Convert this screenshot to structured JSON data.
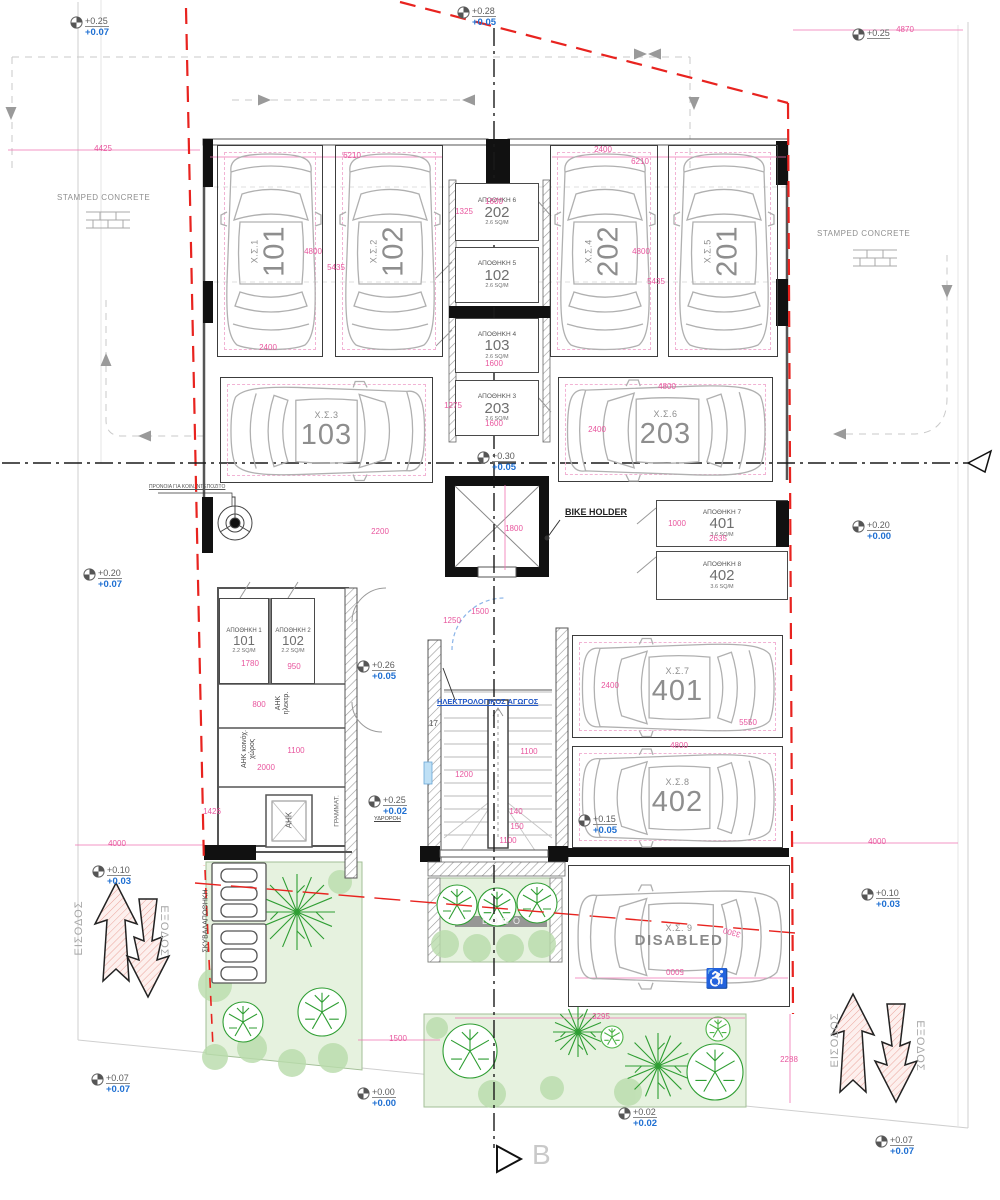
{
  "labels": {
    "stamped_concrete_left": "STAMPED CONCRETE",
    "stamped_concrete_right": "STAMPED CONCRETE",
    "bike_holder": "BIKE HOLDER",
    "provision_note": "ΠΡΟΝΟΙΑ ΓΙΑ ΚΟΙΝ. ΝΤΕΠΟΖΙΤΟ",
    "electrical_duct": "ΗΛΕΚΤΡΟΛΟΓΙΚΟΣ ΑΓΩΓΟΣ",
    "mailboxes": "ΓΡΑΜΜΑΤ.",
    "downpipe": "ΥΔΡΟΡΟΗ",
    "ahk_room": "ΑΗΚ",
    "ahk_electrical_1": "ΑΗΚ",
    "ahk_electrical_2": "ηλεκτρ.",
    "ahk_common_1": "ΑΗΚ κοινόχ.",
    "ahk_common_2": "χώρος",
    "garbage_storage": "ΣΚΥΒΑΛΑΠΟΘΗΚΗ",
    "entrance_left": "ΕΙΣΟΔΟΣ",
    "exit_left": "ΕΞΟΔΟΣ",
    "entrance_right": "ΕΙΣΟΔΟΣ",
    "exit_right": "ΕΞΟΔΟΣ",
    "logo": "LOGO",
    "stair_count": "17",
    "section_b": "B",
    "wheelchair": "♿"
  },
  "parking_stalls": [
    {
      "code": "Χ.Σ.1",
      "number": "101"
    },
    {
      "code": "Χ.Σ.2",
      "number": "102"
    },
    {
      "code": "Χ.Σ.4",
      "number": "202"
    },
    {
      "code": "Χ.Σ.5",
      "number": "201"
    },
    {
      "code": "Χ.Σ.3",
      "number": "103"
    },
    {
      "code": "Χ.Σ.6",
      "number": "203"
    },
    {
      "code": "Χ.Σ.7",
      "number": "401"
    },
    {
      "code": "Χ.Σ.8",
      "number": "402"
    },
    {
      "code": "Χ.Σ. 9",
      "number": "DISABLED"
    }
  ],
  "storage_rooms": [
    {
      "name": "ΑΠΟΘΗΚΗ 6",
      "number": "202",
      "area": "2.6 SQ/M"
    },
    {
      "name": "ΑΠΟΘΗΚΗ 5",
      "number": "102",
      "area": "2.6 SQ/M"
    },
    {
      "name": "ΑΠΟΘΗΚΗ 4",
      "number": "103",
      "area": "2.6 SQ/M"
    },
    {
      "name": "ΑΠΟΘΗΚΗ 3",
      "number": "203",
      "area": "2.6 SQ/M"
    },
    {
      "name": "ΑΠΟΘΗΚΗ 1",
      "number": "101",
      "area": "2.2 SQ/M"
    },
    {
      "name": "ΑΠΟΘΗΚΗ 2",
      "number": "102",
      "area": "2.2 SQ/M"
    },
    {
      "name": "ΑΠΟΘΗΚΗ 7",
      "number": "401",
      "area": "3.6 SQ/M"
    },
    {
      "name": "ΑΠΟΘΗΚΗ 8",
      "number": "402",
      "area": "3.6 SQ/M"
    }
  ],
  "level_markers": [
    {
      "upper": "+0.25",
      "lower": "+0.07"
    },
    {
      "upper": "+0.28",
      "lower": "+0.05"
    },
    {
      "upper": "+0.25",
      "lower": ""
    },
    {
      "upper": "+0.30",
      "lower": "+0.05"
    },
    {
      "upper": "+0.20",
      "lower": "+0.00"
    },
    {
      "upper": "+0.20",
      "lower": "+0.07"
    },
    {
      "upper": "+0.26",
      "lower": "+0.05"
    },
    {
      "upper": "+0.25",
      "lower": "+0.02"
    },
    {
      "upper": "+0.15",
      "lower": "+0.05"
    },
    {
      "upper": "+0.10",
      "lower": "+0.03"
    },
    {
      "upper": "+0.10",
      "lower": "+0.03"
    },
    {
      "upper": "+0.07",
      "lower": "+0.07"
    },
    {
      "upper": "+0.00",
      "lower": "+0.00"
    },
    {
      "upper": "+0.02",
      "lower": "+0.02"
    },
    {
      "upper": "+0.07",
      "lower": "+0.07"
    }
  ],
  "dimensions": [
    "4425",
    "6210",
    "2400",
    "6210",
    "4870",
    "1600",
    "1325",
    "4800",
    "5435",
    "2400",
    "4800",
    "5435",
    "1600",
    "1275",
    "1600",
    "4800",
    "2400",
    "2200",
    "1800",
    "1000",
    "2635",
    "1500",
    "1250",
    "1780",
    "950",
    "800",
    "1100",
    "2000",
    "1426",
    "1100",
    "1200",
    "140",
    "150",
    "1100",
    "2400",
    "5550",
    "4800",
    "3300",
    "5000",
    "4000",
    "4000",
    "1500",
    "3295",
    "2288"
  ],
  "colors": {
    "dimension_pink": "#e8569e",
    "boundary_red": "#e8231f",
    "level_blue": "#1e6fd2",
    "tree_green": "#2f9e33",
    "planter_green": "#e6f2df"
  }
}
